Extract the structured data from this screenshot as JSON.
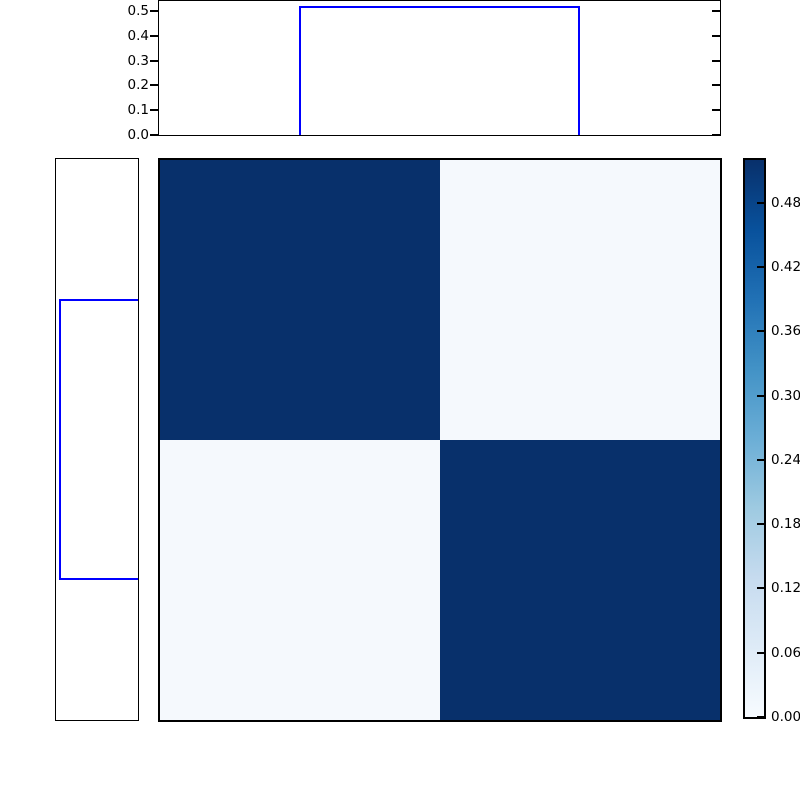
{
  "chart_data": {
    "type": "heatmap",
    "title": "",
    "matrix": [
      [
        0.52,
        0.02
      ],
      [
        0.02,
        0.52
      ]
    ],
    "rows": 2,
    "cols": 2,
    "colormap": "Blues",
    "vmin": 0.0,
    "vmax": 0.52,
    "grid": false,
    "cell_colors": [
      [
        "#08306b",
        "#f5f9fd"
      ],
      [
        "#f5f9fd",
        "#08306b"
      ]
    ],
    "colormap_stops": [
      {
        "pos": 0.0,
        "color": "#f7fbff"
      },
      {
        "pos": 0.125,
        "color": "#deebf7"
      },
      {
        "pos": 0.25,
        "color": "#c6dbef"
      },
      {
        "pos": 0.375,
        "color": "#9ecae1"
      },
      {
        "pos": 0.5,
        "color": "#6baed6"
      },
      {
        "pos": 0.625,
        "color": "#4292c6"
      },
      {
        "pos": 0.75,
        "color": "#2171b5"
      },
      {
        "pos": 0.875,
        "color": "#08519c"
      },
      {
        "pos": 1.0,
        "color": "#08306b"
      }
    ],
    "colorbar": {
      "side": "right",
      "tick_values": [
        0.0,
        0.06,
        0.12,
        0.18,
        0.24,
        0.3,
        0.36,
        0.42,
        0.48
      ],
      "tick_labels": [
        "0.00",
        "0.06",
        "0.12",
        "0.18",
        "0.24",
        "0.30",
        "0.36",
        "0.42",
        "0.48"
      ]
    },
    "top_marginal": {
      "type": "step",
      "line_color": "#0000ff",
      "value": 0.52,
      "bin_start_frac": 0.25,
      "bin_end_frac": 0.75,
      "ylim": [
        0.0,
        0.54
      ],
      "tick_values": [
        0.0,
        0.1,
        0.2,
        0.3,
        0.4,
        0.5
      ],
      "tick_labels": [
        "0.0",
        "0.1",
        "0.2",
        "0.3",
        "0.4",
        "0.5"
      ]
    },
    "left_marginal": {
      "type": "step",
      "line_color": "#0000ff",
      "value": 0.52,
      "bin_start_frac": 0.25,
      "bin_end_frac": 0.75,
      "xlim": [
        0.0,
        0.54
      ]
    },
    "axis_color": "#000000",
    "background": "#ffffff"
  }
}
